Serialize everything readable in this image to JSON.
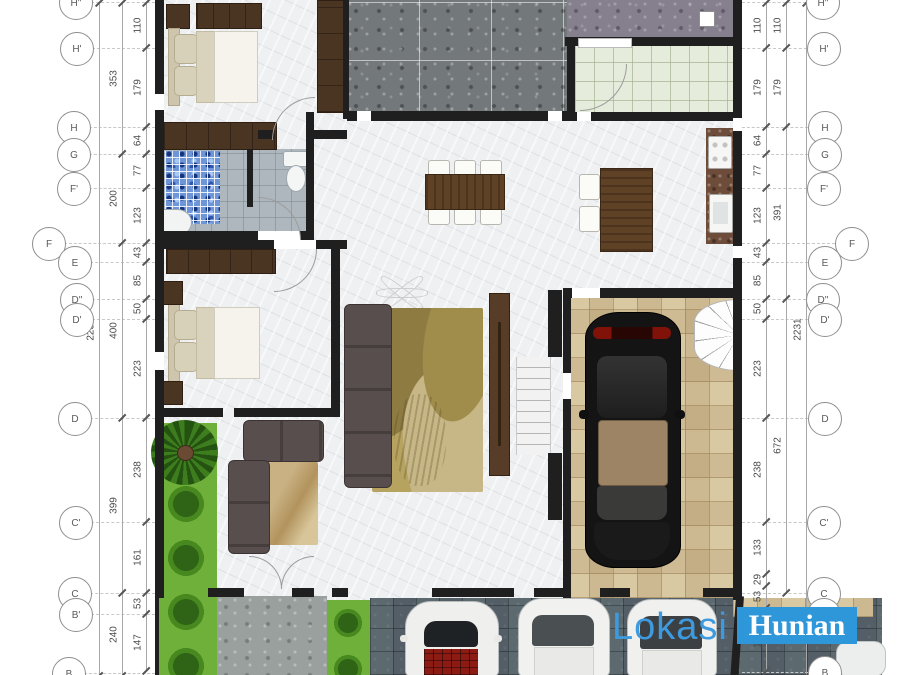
{
  "watermark": {
    "lokasi": "Lokasi",
    "hunian": "Hunian"
  },
  "colors": {
    "watermark_box_blue": "#2e97da",
    "watermark_text_blue": "#3e9ade",
    "wall_black": "#1f1f1f",
    "wardrobe_wood": "#4a3422",
    "table_wood": "#5f4126",
    "grass_green": "#6fb03a",
    "garage_tile_beige": "#d9c9a3",
    "driveway_gray": "#5c666d",
    "mosaic_blue": "#6e95d8",
    "rug_olive": "#b6a35f"
  },
  "annotations": {
    "plan_left_edge": 155,
    "plan_right_edge": 742,
    "left": {
      "bubbles": [
        {
          "label": "H''",
          "x": 75,
          "y": 2
        },
        {
          "label": "H'",
          "x": 76,
          "y": 48
        },
        {
          "label": "H",
          "x": 73,
          "y": 127
        },
        {
          "label": "G",
          "x": 73,
          "y": 154
        },
        {
          "label": "F'",
          "x": 73,
          "y": 188
        },
        {
          "label": "F",
          "x": 48,
          "y": 243
        },
        {
          "label": "E",
          "x": 74,
          "y": 262
        },
        {
          "label": "D''",
          "x": 76,
          "y": 299
        },
        {
          "label": "D'",
          "x": 76,
          "y": 319
        },
        {
          "label": "D",
          "x": 74,
          "y": 418
        },
        {
          "label": "C'",
          "x": 75,
          "y": 522
        },
        {
          "label": "C",
          "x": 74,
          "y": 593
        },
        {
          "label": "B'",
          "x": 75,
          "y": 614
        },
        {
          "label": "B",
          "x": 68,
          "y": 673
        }
      ],
      "lines": [
        {
          "x": 146,
          "boundaries": [
            3,
            48,
            127,
            154,
            188,
            243,
            262,
            299,
            319,
            418,
            522,
            593,
            614,
            671
          ],
          "labels": [
            "110",
            "179",
            "64",
            "77",
            "123",
            "43",
            "85",
            "50",
            "223",
            "238",
            "161",
            "53",
            "147"
          ]
        },
        {
          "x": 122,
          "boundaries": [
            3,
            154,
            243,
            418,
            593,
            676
          ],
          "labels": [
            "353",
            "200",
            "400",
            "399",
            "240"
          ]
        },
        {
          "x": 99,
          "boundaries": [
            3,
            676
          ],
          "labels": [
            "2231"
          ],
          "label_y": [
            330
          ]
        }
      ]
    },
    "right": {
      "bubbles": [
        {
          "label": "H''",
          "x": 822,
          "y": 2
        },
        {
          "label": "H'",
          "x": 823,
          "y": 48
        },
        {
          "label": "H",
          "x": 824,
          "y": 127
        },
        {
          "label": "G",
          "x": 824,
          "y": 154
        },
        {
          "label": "F'",
          "x": 823,
          "y": 188
        },
        {
          "label": "F",
          "x": 851,
          "y": 243
        },
        {
          "label": "E",
          "x": 824,
          "y": 262
        },
        {
          "label": "D''",
          "x": 822,
          "y": 299
        },
        {
          "label": "D'",
          "x": 824,
          "y": 319
        },
        {
          "label": "D",
          "x": 824,
          "y": 418
        },
        {
          "label": "C'",
          "x": 823,
          "y": 522
        },
        {
          "label": "C",
          "x": 823,
          "y": 593
        },
        {
          "label": "B'",
          "x": 823,
          "y": 614
        },
        {
          "label": "B",
          "x": 824,
          "y": 672
        }
      ],
      "lines": [
        {
          "x": 766,
          "boundaries": [
            3,
            48,
            127,
            154,
            188,
            243,
            262,
            299,
            319,
            418,
            522,
            574,
            586,
            608,
            671
          ],
          "labels": [
            "110",
            "179",
            "64",
            "77",
            "123",
            "43",
            "85",
            "50",
            "223",
            "238",
            "133",
            "29",
            "53",
            "147"
          ]
        },
        {
          "x": 786,
          "boundaries": [
            3,
            48,
            127,
            299,
            593
          ],
          "labels": [
            "110",
            "179",
            "391",
            "672"
          ]
        },
        {
          "x": 806,
          "boundaries": [
            3,
            676
          ],
          "labels": [
            "2231"
          ],
          "label_y": [
            330
          ]
        }
      ]
    }
  }
}
